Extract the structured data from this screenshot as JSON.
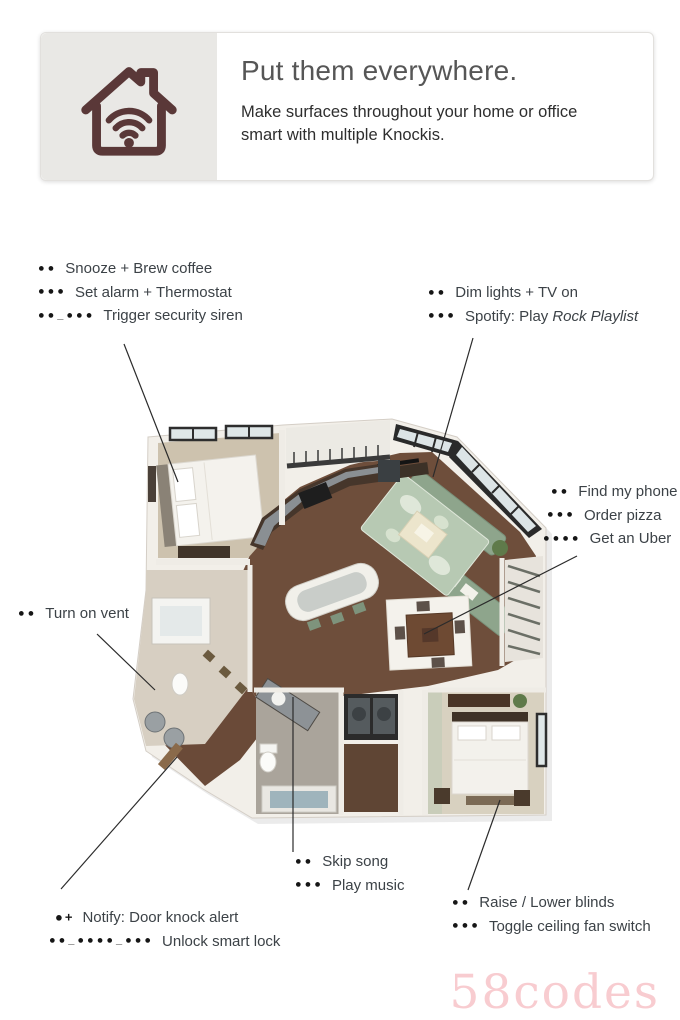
{
  "header": {
    "title": "Put them everywhere.",
    "subtitle": "Make surfaces throughout your home or office smart with multiple Knockis.",
    "icon_name": "house-wifi-icon"
  },
  "annotations": {
    "groups": [
      {
        "name": "bedroom-kitchen-knocki",
        "rows": [
          {
            "pattern": "●●",
            "label": "Snooze + Brew coffee"
          },
          {
            "pattern": "●●●",
            "label": "Set alarm + Thermostat"
          },
          {
            "pattern": "●●_●●●",
            "label": "Trigger security siren"
          }
        ]
      },
      {
        "name": "living-room-knocki",
        "rows": [
          {
            "pattern": "●●",
            "label": "Dim lights + TV on"
          },
          {
            "pattern": "●●●",
            "label": "Spotify: Play",
            "label_italic": "Rock Playlist"
          }
        ]
      },
      {
        "name": "dining-knocki",
        "rows": [
          {
            "pattern": "●●",
            "label": "Find my phone"
          },
          {
            "pattern": "●●●",
            "label": "Order pizza"
          },
          {
            "pattern": "●●●●",
            "label": "Get an Uber"
          }
        ]
      },
      {
        "name": "bathroom-knocki",
        "rows": [
          {
            "pattern": "●●",
            "label": "Turn on vent"
          }
        ]
      },
      {
        "name": "music-knocki",
        "rows": [
          {
            "pattern": "●●",
            "label": "Skip song"
          },
          {
            "pattern": "●●●",
            "label": "Play music"
          }
        ]
      },
      {
        "name": "front-door-knocki",
        "rows": [
          {
            "pattern": "●+",
            "label": "Notify: Door knock alert"
          },
          {
            "pattern": "●●_●●●●_●●●",
            "label": "Unlock smart lock"
          }
        ]
      },
      {
        "name": "bedroom2-knocki",
        "rows": [
          {
            "pattern": "●●",
            "label": "Raise / Lower blinds"
          },
          {
            "pattern": "●●●",
            "label": "Toggle ceiling fan switch"
          }
        ]
      }
    ]
  },
  "watermark": {
    "text": "58codes",
    "color": "#f8ccd0"
  },
  "palette": {
    "accent_icon": "#5a3838",
    "header_panel": "#e9e8e5",
    "annotation_text": "#3c4247",
    "dot_color": "#161616",
    "floor_wood": "#6e4e3b",
    "wall_white": "#f2efe9",
    "sofa_green": "#8ea58c",
    "rug_green": "#b7c9b3"
  }
}
